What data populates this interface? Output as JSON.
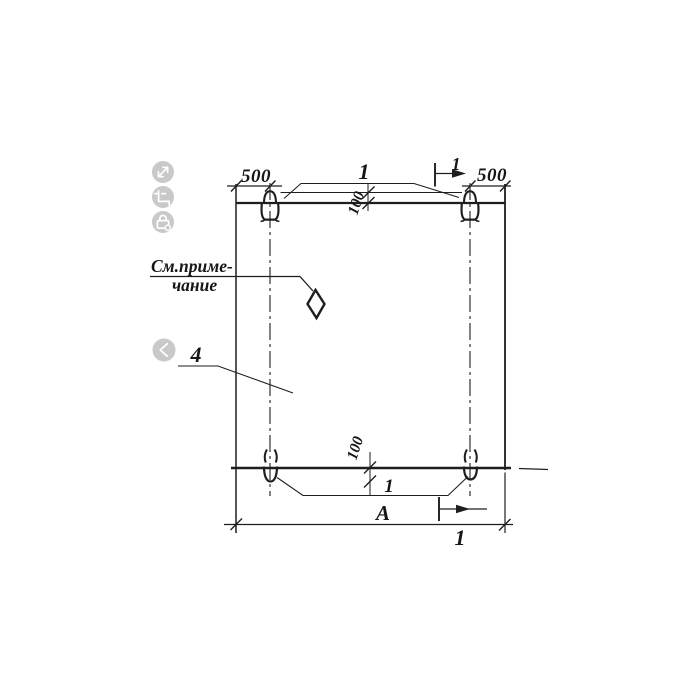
{
  "drawing": {
    "dimensions": {
      "top_left": "500",
      "top_right": "500",
      "loop_offset_top": "100",
      "loop_offset_bottom": "100",
      "overall_width": "А"
    },
    "callouts": {
      "loops_top": "1",
      "loops_bottom": "1",
      "part": "4"
    },
    "section_marks": {
      "top": "1",
      "bottom": "1"
    },
    "note": {
      "line1": "См.приме-",
      "line2": "чание"
    }
  },
  "viewer": {
    "controls": [
      {
        "icon": "expand-icon"
      },
      {
        "icon": "crop-icon"
      },
      {
        "icon": "lock-icon"
      },
      {
        "icon": "chevron-left-icon"
      }
    ]
  },
  "colors": {
    "ink": "#1e1e1e",
    "icon_bg": "#c9c9c9",
    "icon_glyph": "#ffffff",
    "background": "#ffffff"
  }
}
